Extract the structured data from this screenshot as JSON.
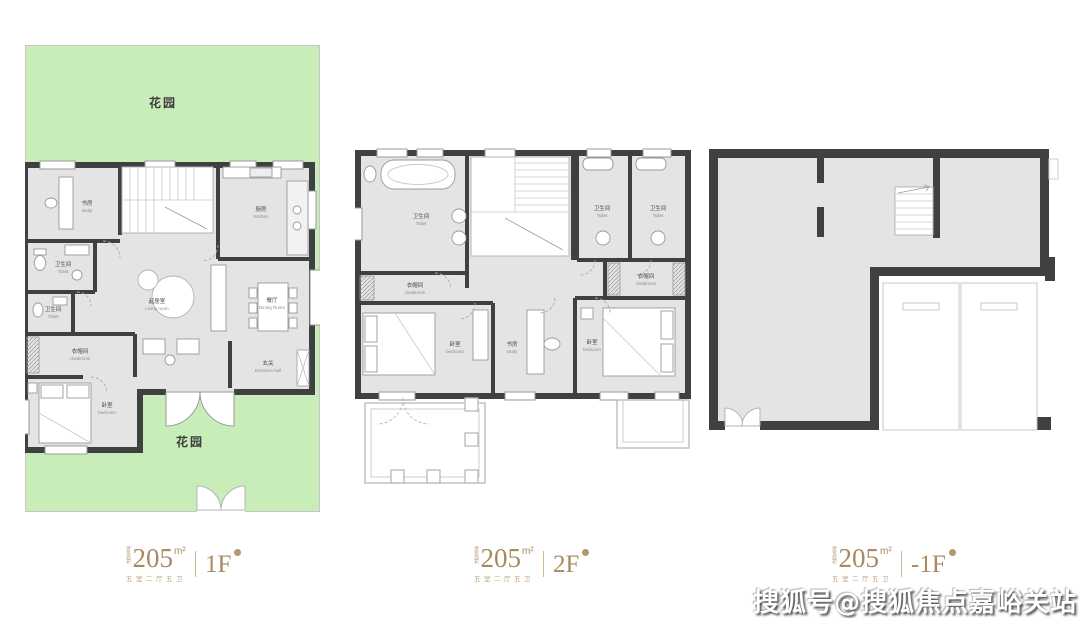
{
  "watermark": {
    "text": "搜狐号@搜狐焦点嘉峪关站"
  },
  "colors": {
    "garden": "#c9edb8",
    "floor": "#e4e4e4",
    "wall": "#3f4040",
    "gold": "#a9895f",
    "fixture_line": "#9a9a9a"
  },
  "labels": {
    "f1": {
      "area_prefix": "建筑面积",
      "area": "205",
      "unit": "m²",
      "desc": "五室二厅五卫",
      "floor": "1F"
    },
    "f2": {
      "area_prefix": "建筑面积",
      "area": "205",
      "unit": "m²",
      "desc": "五室二厅五卫",
      "floor": "2F"
    },
    "b1": {
      "area_prefix": "建筑面积",
      "area": "205",
      "unit": "m²",
      "desc": "五室二厅五卫",
      "floor": "-1F"
    }
  },
  "f1": {
    "garden_top": "花园",
    "garden_bottom": "花园",
    "rooms": {
      "study": {
        "zh": "书房",
        "en": "study"
      },
      "toilet_a": {
        "zh": "卫生间",
        "en": "Toilet"
      },
      "toilet_b": {
        "zh": "卫生间",
        "en": "Toilet"
      },
      "cloakroom": {
        "zh": "衣帽间",
        "en": "cloakroom"
      },
      "bedroom": {
        "zh": "卧室",
        "en": "bedroom"
      },
      "kitchen": {
        "zh": "厨房",
        "en": "Kitchen"
      },
      "living": {
        "zh": "起居室",
        "en": "Living room"
      },
      "dining": {
        "zh": "餐厅",
        "en": "Dining Room"
      },
      "entrance": {
        "zh": "玄关",
        "en": "Entrance hall"
      }
    }
  },
  "f2": {
    "rooms": {
      "bath": {
        "zh": "卫生间",
        "en": "Toilet"
      },
      "toilet_a": {
        "zh": "卫生间",
        "en": "Toilet"
      },
      "toilet_b": {
        "zh": "卫生间",
        "en": "Toilet"
      },
      "cloak_left": {
        "zh": "衣帽间",
        "en": "cloakroom"
      },
      "cloak_right": {
        "zh": "衣帽间",
        "en": "cloakroom"
      },
      "bedroom_left": {
        "zh": "卧室",
        "en": "bedroom"
      },
      "study": {
        "zh": "书房",
        "en": "study"
      },
      "bedroom_right": {
        "zh": "卧室",
        "en": "bedroom"
      }
    }
  }
}
